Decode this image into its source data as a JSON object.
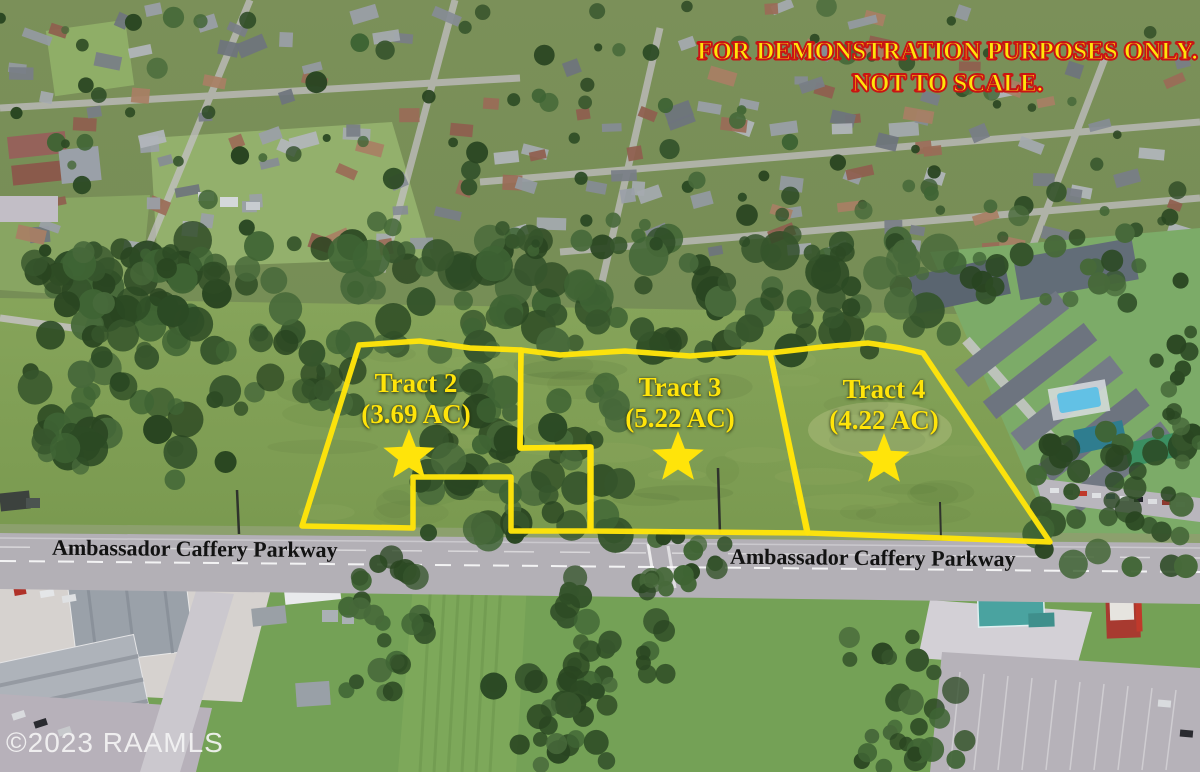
{
  "overlay": {
    "disclaimer": {
      "line1": "FOR DEMONSTRATION PURPOSES ONLY.",
      "line2": "NOT TO SCALE."
    },
    "road_labels": {
      "left": "Ambassador Caffery Parkway",
      "right": "Ambassador Caffery Parkway"
    },
    "watermark": "©2023 RAAMLS"
  },
  "tracts": [
    {
      "name": "Tract 2",
      "acreage": "(3.69 AC)",
      "marker": "star"
    },
    {
      "name": "Tract 3",
      "acreage": "(5.22 AC)",
      "marker": "star"
    },
    {
      "name": "Tract 4",
      "acreage": "(4.22 AC)",
      "marker": "star"
    }
  ],
  "icons": {
    "tract_marker": "star"
  },
  "colors": {
    "tract_outline": "#FFE40A",
    "tract_text": "#FFE40A",
    "disclaimer_fill": "#FFE40A",
    "disclaimer_stroke": "#C81414",
    "road_text": "#121212",
    "watermark": "#F4F4F4"
  }
}
